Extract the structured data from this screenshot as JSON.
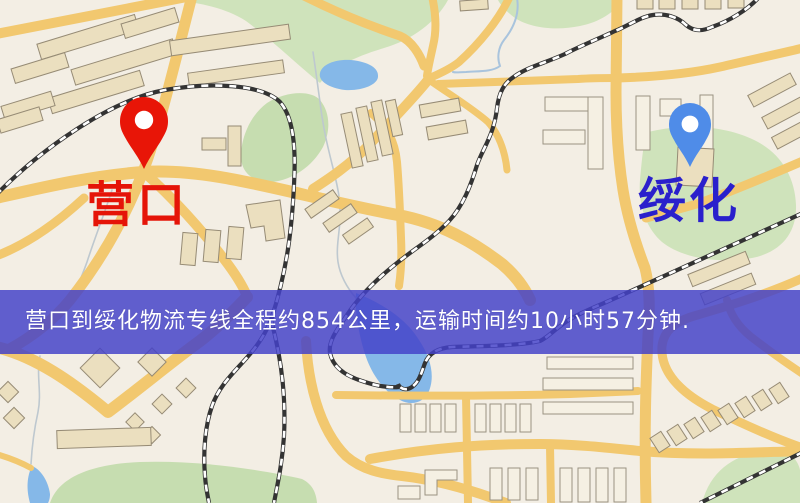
{
  "map": {
    "origin": {
      "name": "营口",
      "pin_color": "#e81507",
      "label_color": "#e51408"
    },
    "destination": {
      "name": "绥化",
      "pin_color": "#4f8ce8",
      "label_color": "#2a20cc"
    },
    "banner": {
      "text": "营口到绥化物流专线全程约854公里，运输时间约10小时57分钟.",
      "background_color": "#4442c8",
      "text_color": "#ffffff",
      "distance_text": "约854公里",
      "duration_text": "约10小时57分钟"
    }
  },
  "theme": {
    "land": "#f3eee4",
    "road": "#f2c86f",
    "park": "#cfe3bb",
    "water": "#85b8e8",
    "building": "#ebdfbf",
    "railway": "#333333"
  }
}
